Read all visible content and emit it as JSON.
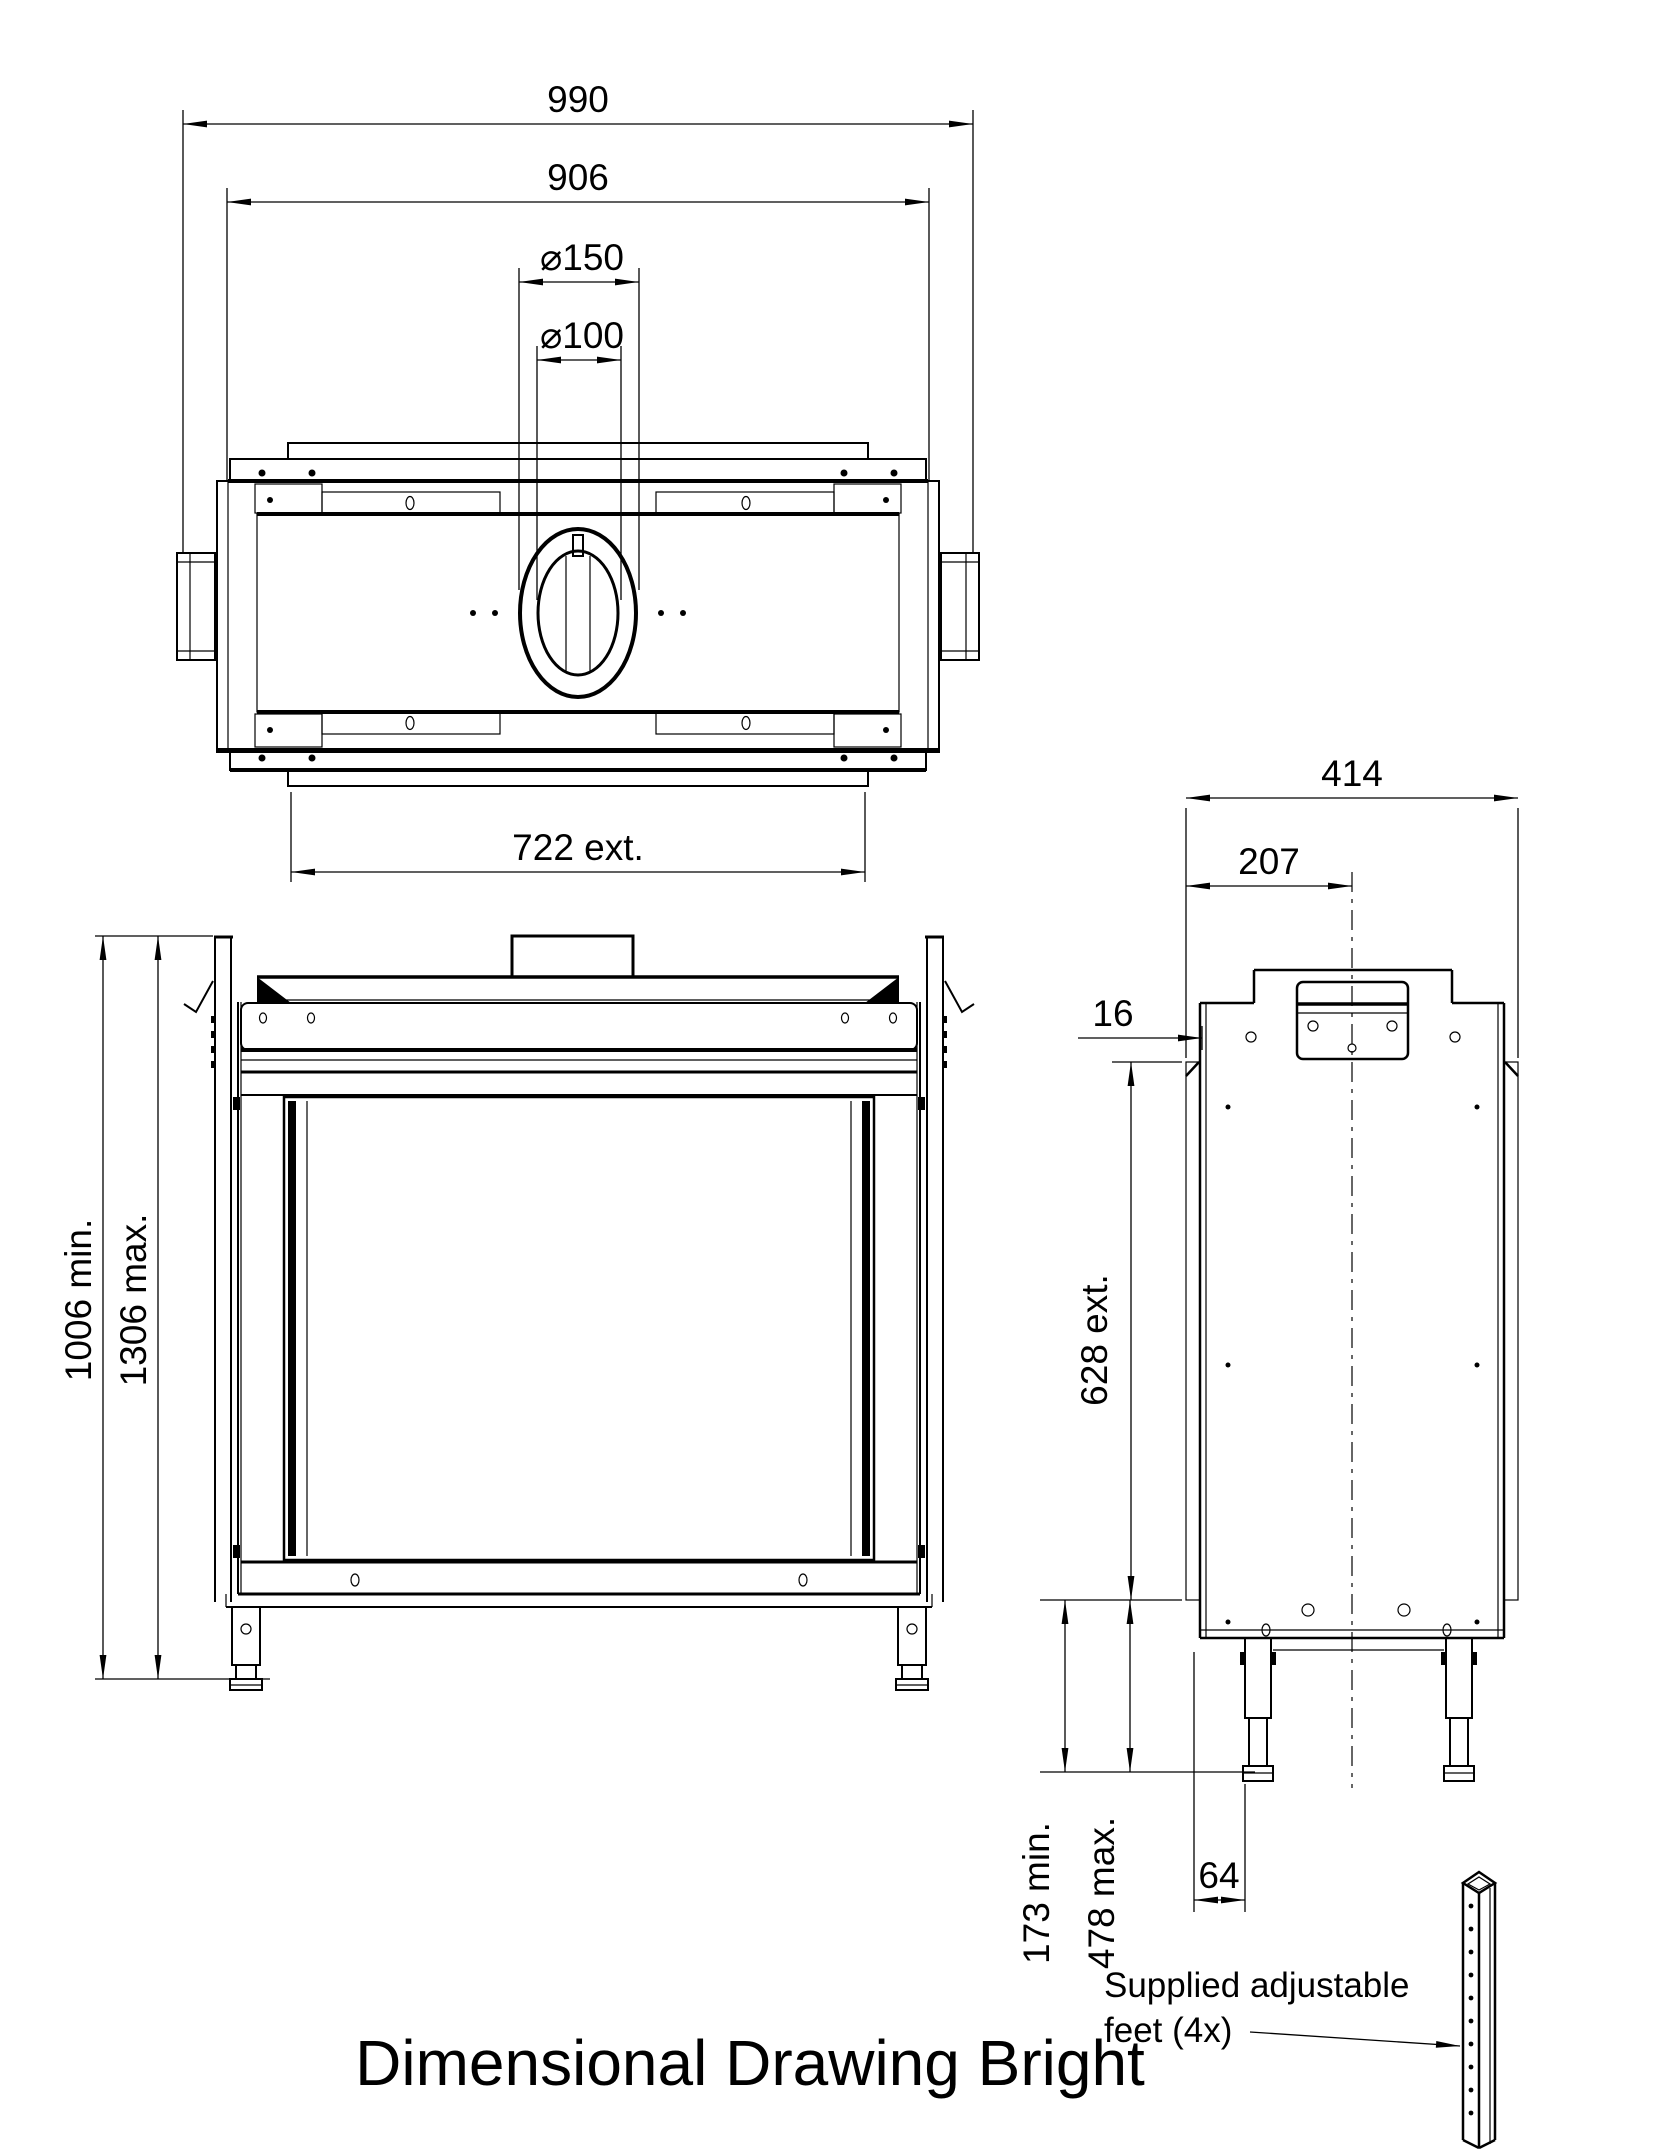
{
  "title": "Dimensional Drawing Bright",
  "colors": {
    "line": "#000000",
    "background": "#ffffff"
  },
  "top_view": {
    "dim_overall_width": "990",
    "dim_body_width": "906",
    "dim_flue_outer": "⌀150",
    "dim_flue_inner": "⌀100",
    "dim_exterior_width": "722 ext."
  },
  "front_view": {
    "dim_height_min": "1006 min.",
    "dim_height_max": "1306 max."
  },
  "side_view": {
    "dim_depth": "414",
    "dim_flue_center": "207",
    "dim_frame_offset": "16",
    "dim_exterior_depth": "628 ext.",
    "dim_feet_min": "173 min.",
    "dim_feet_max": "478 max.",
    "dim_foot_inset": "64"
  },
  "feet_note": {
    "line1": "Supplied adjustable",
    "line2": "feet (4x)"
  }
}
